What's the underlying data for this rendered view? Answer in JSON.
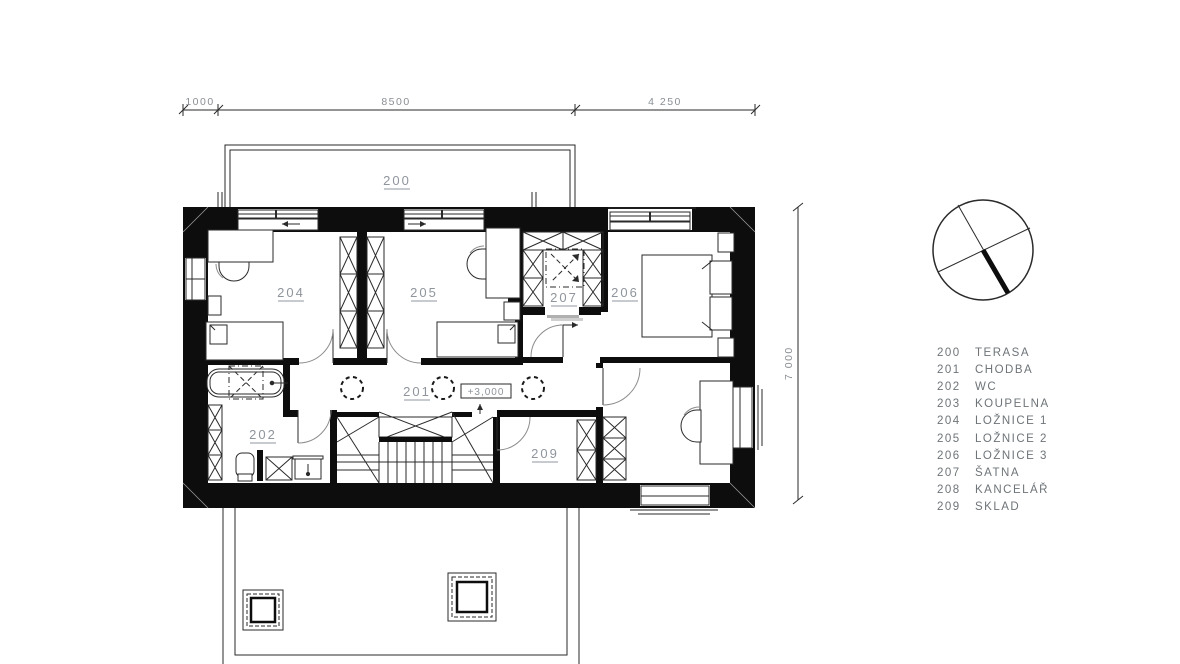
{
  "drawing": {
    "type": "floor-plan",
    "elevation_marker": "+3,000"
  },
  "dimensions": {
    "top_left": "1000",
    "top_mid": "8500",
    "top_right": "4 250",
    "right_side": "7 000"
  },
  "room_labels": {
    "terasa": "200",
    "chodba": "201",
    "wc": "202",
    "loznice1": "204",
    "loznice2": "205",
    "loznice3": "206",
    "satna": "207",
    "sklad": "209"
  },
  "legend": {
    "items": [
      {
        "num": "200",
        "name": "TERASA"
      },
      {
        "num": "201",
        "name": "CHODBA"
      },
      {
        "num": "202",
        "name": "WC"
      },
      {
        "num": "203",
        "name": "KOUPELNA"
      },
      {
        "num": "204",
        "name": "LOŽNICE 1"
      },
      {
        "num": "205",
        "name": "LOŽNICE 2"
      },
      {
        "num": "206",
        "name": "LOŽNICE 3"
      },
      {
        "num": "207",
        "name": "ŠATNA"
      },
      {
        "num": "208",
        "name": "KANCELÁŘ"
      },
      {
        "num": "209",
        "name": "SKLAD"
      }
    ]
  },
  "colors": {
    "wall": "#0d0d0d",
    "line": "#2a2a2a",
    "label_gray": "#8f959c",
    "legend_gray": "#6e7478",
    "background": "#ffffff"
  }
}
